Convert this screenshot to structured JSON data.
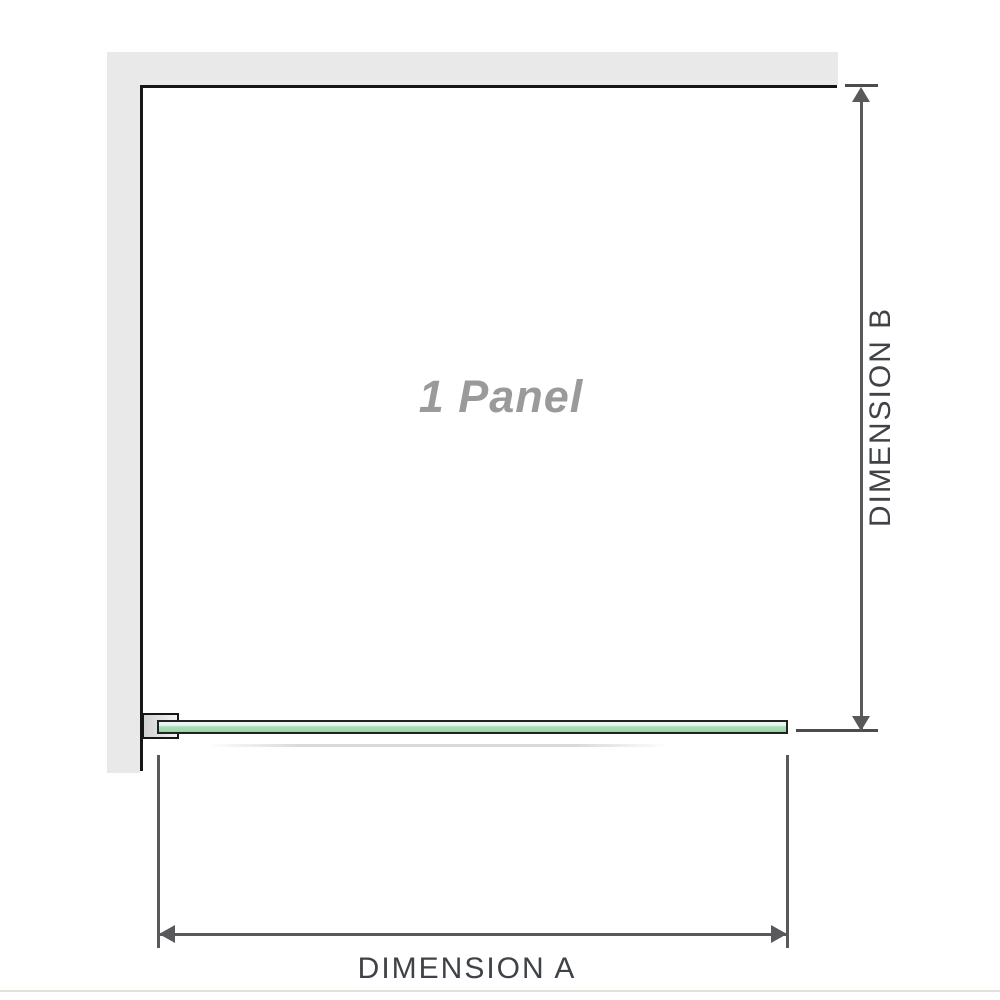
{
  "diagram": {
    "panel_label": "1 Panel",
    "dimension_a_label": "DIMENSION A",
    "dimension_b_label": "DIMENSION B"
  },
  "colors": {
    "wall_gray": "#e9e9e9",
    "outline_black": "#161616",
    "glass_green": "#a6dab4",
    "glass_green_dark": "#8fd0a2",
    "glass_highlight": "#eaf7ee",
    "glass_border": "#222222",
    "dim_line_gray": "#58595b",
    "tick_gray": "#4c4c4c",
    "label_gray": "#3f4347",
    "panel_text_gray": "#9a9a9a",
    "bracket_fill_dark": "#d2d2d2",
    "bracket_fill_light": "#f3f3f3",
    "divider_beige": "#e2e1d9"
  }
}
